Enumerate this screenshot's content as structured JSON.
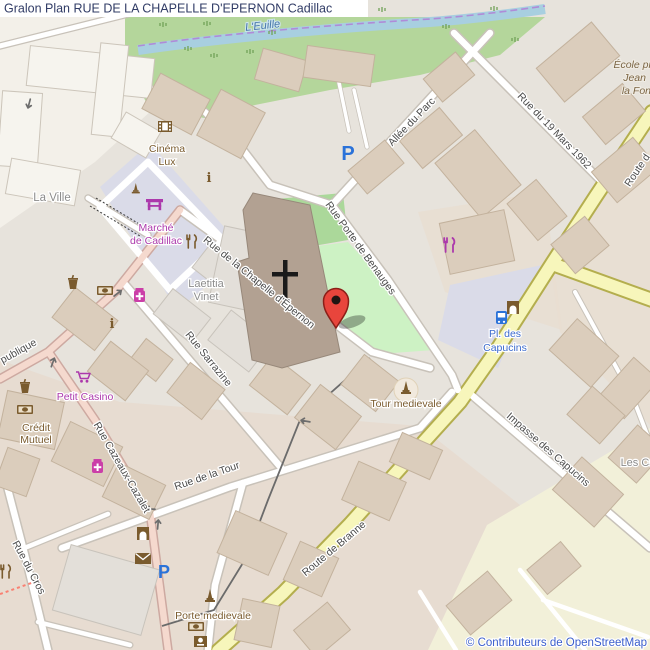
{
  "window": {
    "title": "Gralon Plan RUE DE LA CHAPELLE D'EPERNON Cadillac"
  },
  "map": {
    "streets": {
      "euille": "L'Euille",
      "allee_du_parc": "Allée du Parc",
      "rue_19_mars": "Rue du 19 Mars 1962",
      "route_top": "Route d",
      "benauges": "Rue Porte de Benauges",
      "chapelle": "Rue de la Chapelle d'Épernon",
      "sarrazine": "Rue Sarrazine",
      "publique": "publique",
      "cazeaux": "Rue Cazeaux-Cazalet",
      "rue_de_la_tour": "Rue de la Tour",
      "cros": "Rue du Cros",
      "impasse": "Impasse des Capucins",
      "branne": "Route de Branne"
    },
    "places": {
      "la_ville": "La Ville",
      "laetitia_1": "Laetitia",
      "laetitia_2": "Vinet",
      "les_capucins": "Les Ca",
      "ecole_1": "École pr",
      "ecole_2": "Jean",
      "ecole_3": "la Fon"
    },
    "pois": {
      "cinema_1": "Cinéma",
      "cinema_2": "Lux",
      "marche_1": "Marché",
      "marche_2": "de Cadillac",
      "petit_casino": "Petit Casino",
      "credit_1": "Crédit",
      "credit_2": "Mutuel",
      "tour_medievale": "Tour medievale",
      "porte_medievale": "Porte medievale",
      "capucins_1": "Pl. des",
      "capucins_2": "Capucins",
      "parking": "P",
      "info": "i"
    },
    "icons": {
      "cinema": "film-strip",
      "market": "market-stall",
      "restaurant": "fork-knife",
      "pharmacy": "medical-cross",
      "bank": "banknote",
      "post": "envelope",
      "bus_stop": "bus",
      "monument": "obelisk",
      "gate": "city-gate",
      "cafe": "cup",
      "supermarket": "shopping-cart",
      "church": "cross"
    },
    "attribution": "© Contributeurs de OpenStreetMap"
  },
  "colors": {
    "marker": "#e8453c",
    "marker_border": "#8c1f18",
    "road_tertiary": "#f7f6bb",
    "water": "#a8cfe0",
    "park": "#cdf2c4",
    "grass": "#b4d69b",
    "pedestrian_area": "#dadbe8",
    "poi_brown": "#7a5b2e",
    "poi_magenta": "#ac39ac",
    "poi_blue": "#2a72d9",
    "attribution_blue": "#3b5ecc",
    "title_color": "#313c66"
  }
}
